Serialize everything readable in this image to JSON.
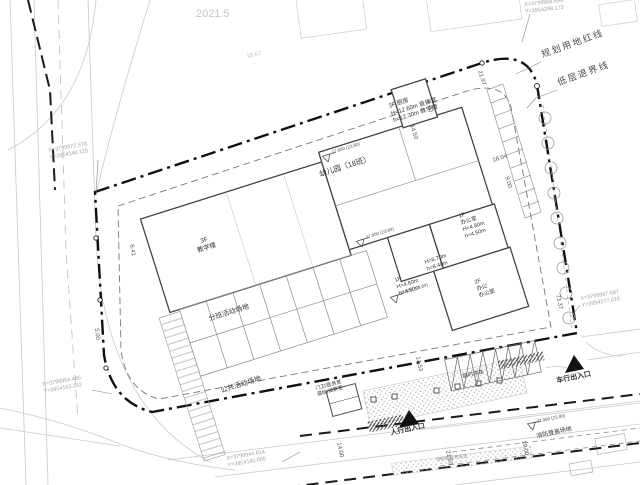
{
  "note_top": "2021.5",
  "boundary": {
    "red_line": "规划用地红线",
    "setback": "低层退界线"
  },
  "buildings": {
    "annotation": {
      "l1": "3F 厨房",
      "l2": "H=12.60m 音体室",
      "l3": "h=12.30m 教学楼"
    },
    "kindergarten": "幼儿园（18班）",
    "teaching_l1": "3F",
    "teaching_l2": "教学楼",
    "office_a_l1": "1F",
    "office_a_l2": "办公室",
    "office_a_l3": "H=4.80m",
    "office_a_l4": "h=4.50m",
    "office_b_l1": "1F",
    "office_b_l2": "H=4.80m",
    "office_b_l3": "h=4.50m",
    "height_l1": "H=8.70m",
    "height_l2": "h=8.40m",
    "office_c_l1": "2F",
    "office_c_l2": "办公",
    "office_c_l3": "办公室",
    "gatehouse_l1": "门卫/医务室",
    "gatehouse_l2": "晨检/观察室"
  },
  "areas": {
    "class_activity": "分班活动场地",
    "public_activity": "公共活动场地",
    "temp_parking": "临时停车",
    "fire_lane": "消防登高场地",
    "bike_parking": "非机动车停车位"
  },
  "entrances": {
    "pedestrian": "人行出入口",
    "vehicle": "车行出入口"
  },
  "dims": {
    "d1": "21.97",
    "d2": "9.00",
    "d3": "14.50",
    "d4": "18.04",
    "d5": "9.00",
    "d6": "6.41",
    "d7": "5.00",
    "d8": "73.37",
    "d9": "13.53",
    "d10": "21.63",
    "d11": "14.00",
    "d12": "19.00",
    "d13": "18.67"
  },
  "elevation": "27.900 (23.80)",
  "coords": {
    "c1x": "X=3799972.578",
    "c1y": "Y=3954148.125",
    "c2x": "X=3799954.485",
    "c2y": "Y=3954163.352",
    "c3x": "X=3799944.614",
    "c3y": "Y=3954180.605",
    "c4x": "X=3799987.687",
    "c4y": "Y=3954277.016",
    "c5x": "X=3799968.699",
    "c5y": "Y=3954298.172"
  },
  "colors": {
    "boundary": "#111111",
    "building_line": "#444444",
    "faint": "#c9c9c9",
    "text": "#333333",
    "coord": "#a3a3a3"
  }
}
